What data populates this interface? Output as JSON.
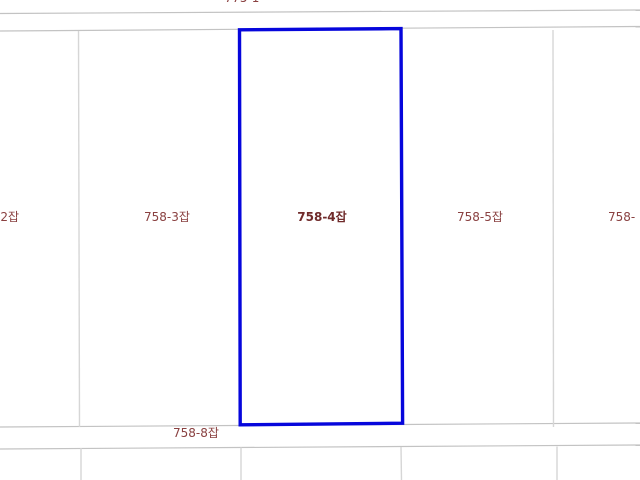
{
  "map": {
    "kind": "cadastral-parcel-map",
    "colors": {
      "background": "#ffffff",
      "boundary_line": "#d6d6d6",
      "road_line": "#c3c3c3",
      "selected_outline": "#0606dc",
      "label_text": "#8a4141"
    },
    "selected_parcel": "758-4잡",
    "north_clipped_label": "775-1",
    "parcel_row": [
      {
        "label": "-2잡",
        "clipped": "left"
      },
      {
        "label": "758-3잡"
      },
      {
        "label": "758-4잡",
        "selected": true
      },
      {
        "label": "758-5잡"
      },
      {
        "label": "758-",
        "clipped": "right"
      }
    ],
    "road_label": "758-8잡"
  }
}
